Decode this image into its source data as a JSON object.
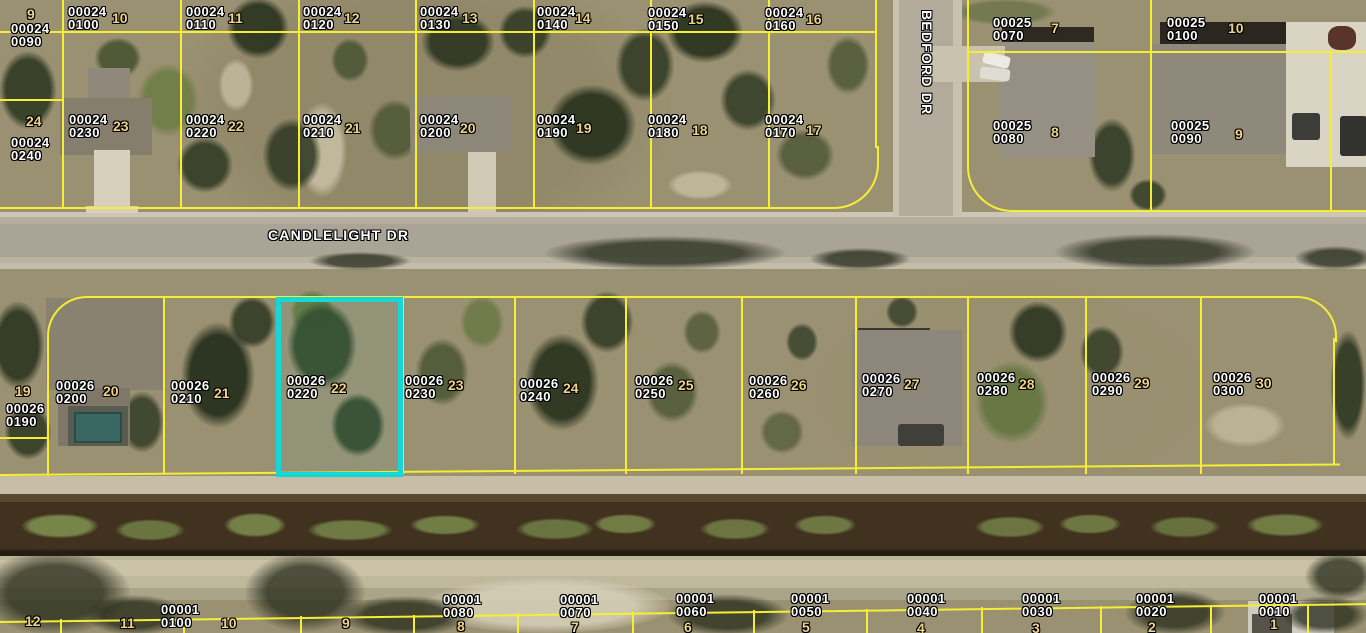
{
  "streets": {
    "horizontal_label": "CANDLELIGHT DR",
    "vertical_label": "BEDFORD DR"
  },
  "colors": {
    "parcel_line": "#f6ee35",
    "highlight": "#17d6d6",
    "parcel_label_text": "#ffffff",
    "lot_number_text": "#eed289"
  },
  "highlighted_parcel": {
    "strap": "00026 0220",
    "lot": "22"
  },
  "parcels": {
    "north_row1": [
      {
        "b": "00024",
        "p": "0090",
        "lot": "9"
      },
      {
        "b": "00024",
        "p": "0100",
        "lot": "10"
      },
      {
        "b": "00024",
        "p": "0110",
        "lot": "11"
      },
      {
        "b": "00024",
        "p": "0120",
        "lot": "12"
      },
      {
        "b": "00024",
        "p": "0130",
        "lot": "13"
      },
      {
        "b": "00024",
        "p": "0140",
        "lot": "14"
      },
      {
        "b": "00024",
        "p": "0150",
        "lot": "15"
      },
      {
        "b": "00024",
        "p": "0160",
        "lot": "16"
      },
      {
        "b": "00025",
        "p": "0070",
        "lot": "7"
      },
      {
        "b": "00025",
        "p": "0100",
        "lot": "10"
      }
    ],
    "north_row2": [
      {
        "b": "00024",
        "p": "0240",
        "lot": "24"
      },
      {
        "b": "00024",
        "p": "0230",
        "lot": "23"
      },
      {
        "b": "00024",
        "p": "0220",
        "lot": "22"
      },
      {
        "b": "00024",
        "p": "0210",
        "lot": "21"
      },
      {
        "b": "00024",
        "p": "0200",
        "lot": "20"
      },
      {
        "b": "00024",
        "p": "0190",
        "lot": "19"
      },
      {
        "b": "00024",
        "p": "0180",
        "lot": "18"
      },
      {
        "b": "00024",
        "p": "0170",
        "lot": "17"
      },
      {
        "b": "00025",
        "p": "0080",
        "lot": "8"
      },
      {
        "b": "00025",
        "p": "0090",
        "lot": "9"
      }
    ],
    "middle_row": [
      {
        "b": "00026",
        "p": "0190",
        "lot": "19"
      },
      {
        "b": "00026",
        "p": "0200",
        "lot": "20"
      },
      {
        "b": "00026",
        "p": "0210",
        "lot": "21"
      },
      {
        "b": "00026",
        "p": "0220",
        "lot": "22"
      },
      {
        "b": "00026",
        "p": "0230",
        "lot": "23"
      },
      {
        "b": "00026",
        "p": "0240",
        "lot": "24"
      },
      {
        "b": "00026",
        "p": "0250",
        "lot": "25"
      },
      {
        "b": "00026",
        "p": "0260",
        "lot": "26"
      },
      {
        "b": "00026",
        "p": "0270",
        "lot": "27"
      },
      {
        "b": "00026",
        "p": "0280",
        "lot": "28"
      },
      {
        "b": "00026",
        "p": "0290",
        "lot": "29"
      },
      {
        "b": "00026",
        "p": "0300",
        "lot": "30"
      }
    ],
    "south_row": [
      {
        "lot": "12"
      },
      {
        "lot": "11"
      },
      {
        "b": "00001",
        "p": "0100",
        "lot": "10"
      },
      {
        "lot": "9"
      },
      {
        "b": "00001",
        "p": "0080",
        "lot": "8"
      },
      {
        "b": "00001",
        "p": "0070",
        "lot": "7"
      },
      {
        "b": "00001",
        "p": "0060",
        "lot": "6"
      },
      {
        "b": "00001",
        "p": "0050",
        "lot": "5"
      },
      {
        "b": "00001",
        "p": "0040",
        "lot": "4"
      },
      {
        "b": "00001",
        "p": "0030",
        "lot": "3"
      },
      {
        "b": "00001",
        "p": "0020",
        "lot": "2"
      },
      {
        "b": "00001",
        "p": "0010",
        "lot": "1"
      }
    ]
  }
}
